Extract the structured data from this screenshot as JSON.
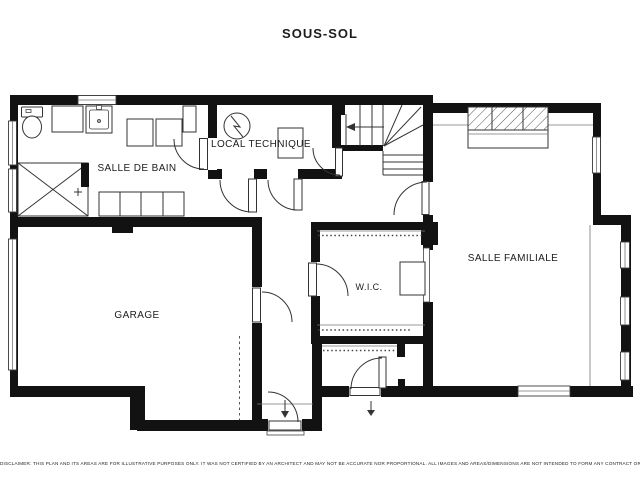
{
  "title": "SOUS-SOL",
  "rooms": {
    "salle_de_bain": "SALLE DE BAIN",
    "local_technique": "LOCAL TECHNIQUE",
    "garage": "GARAGE",
    "wic": "W.I.C.",
    "salle_familiale": "SALLE FAMILIALE"
  },
  "disclaimer": "DISCLAIMER: THIS PLAN AND ITS AREAS ARE FOR ILLUSTRATIVE PURPOSES ONLY. IT WAS NOT CERTIFIED BY AN ARCHITECT AND MAY NOT BE ACCURATE NOR PROPORTIONAL. ALL IMAGES AND AREAS/DIMENSIONS ARE NOT INTENDED TO FORM ANY CONTRACT OR WARRANTY.",
  "colors": {
    "wall": "#121212",
    "line": "#333333",
    "text": "#1c1c1c",
    "background": "#ffffff"
  }
}
